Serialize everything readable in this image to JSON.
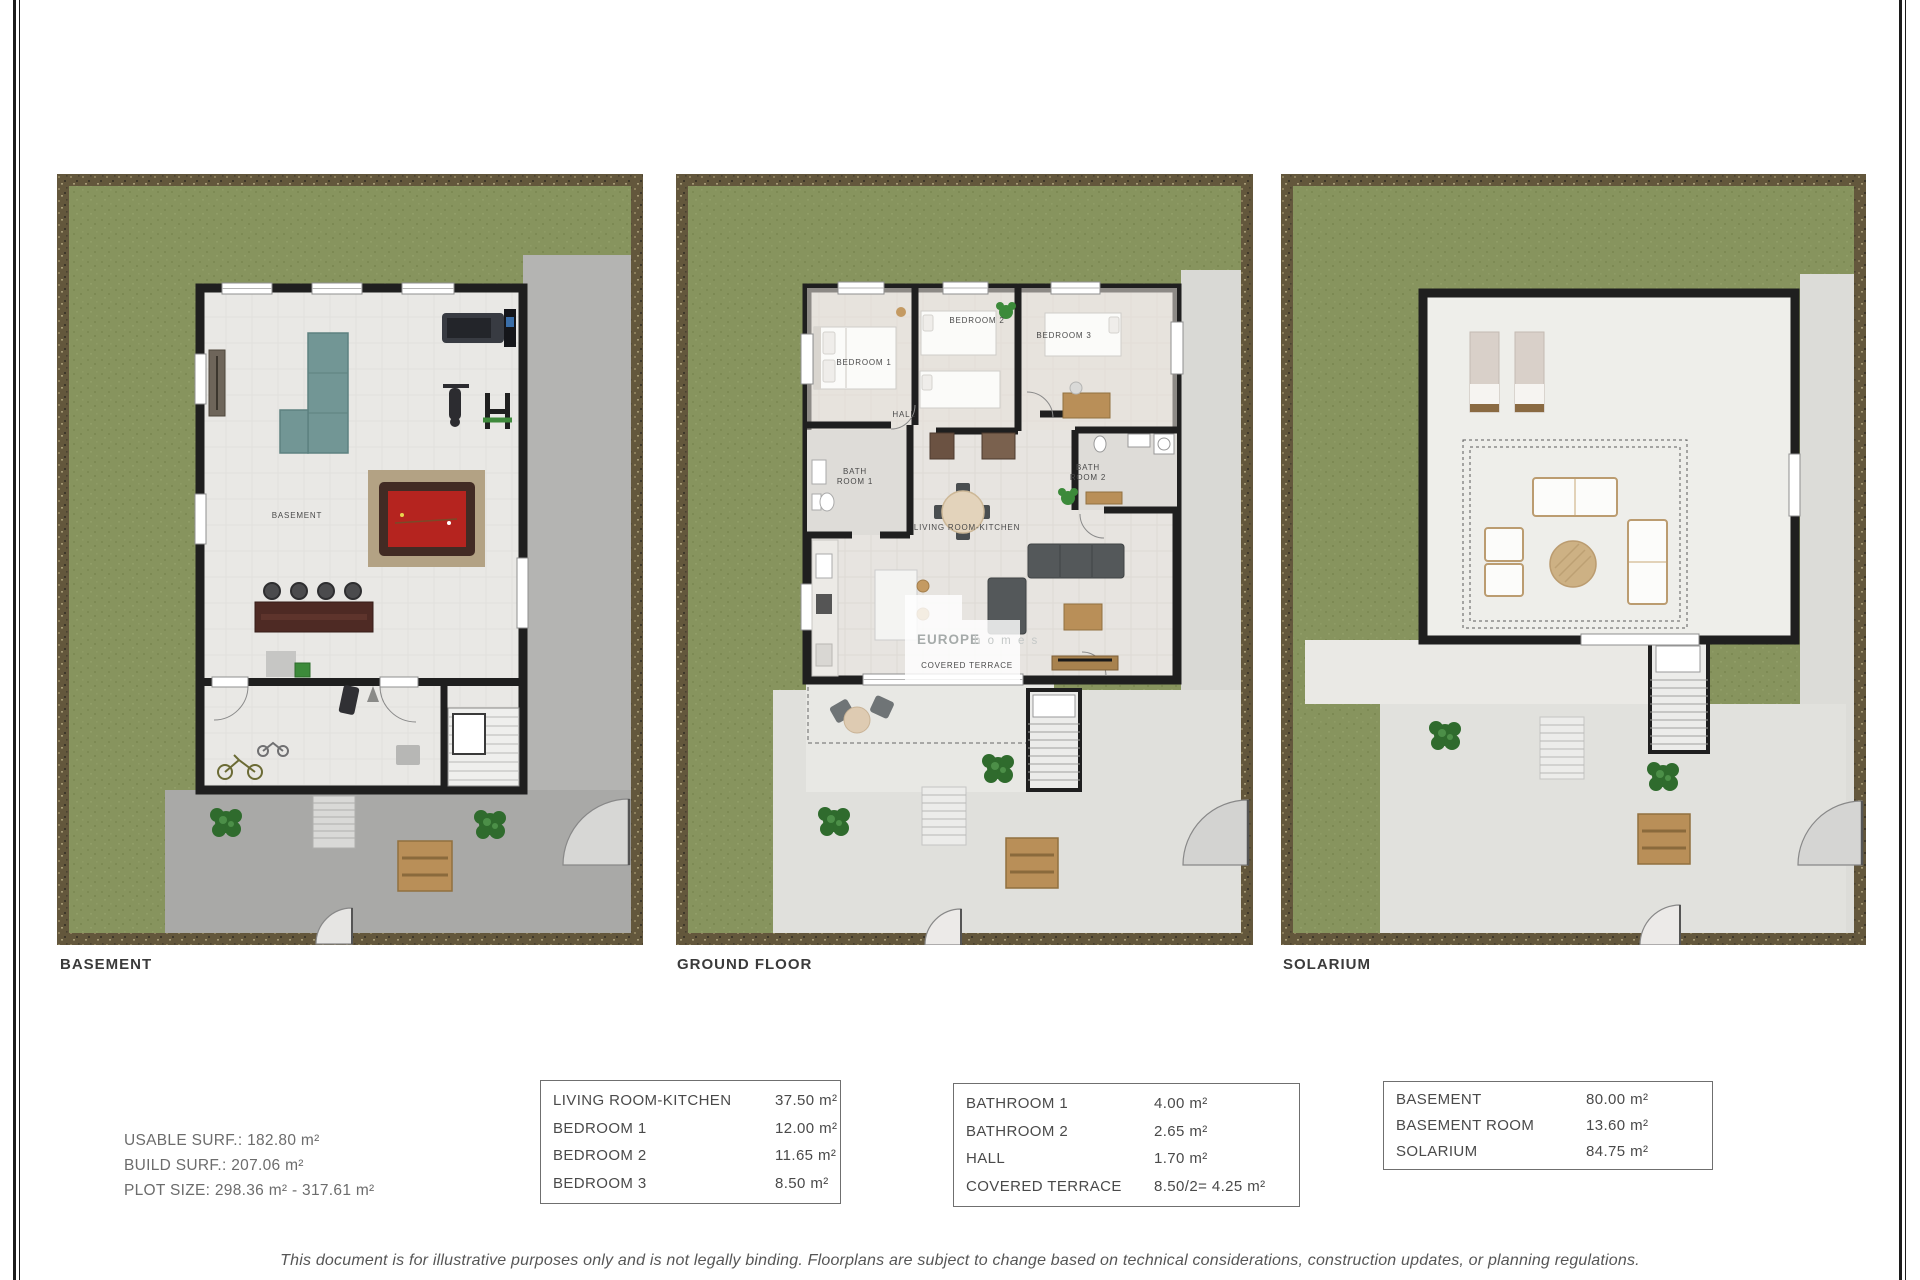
{
  "plans": [
    {
      "caption": "BASEMENT",
      "room_label": "BASEMENT"
    },
    {
      "caption": "GROUND FLOOR",
      "rooms": {
        "bedroom1": "BEDROOM 1",
        "bedroom2": "BEDROOM 2",
        "bedroom3": "BEDROOM 3",
        "hall": "HALL",
        "bath_line1": "BATH",
        "bath1_line2": "ROOM 1",
        "bath2_line2": "ROOM 2",
        "living_kitchen": "LIVING ROOM-KITCHEN",
        "covered_terrace": "COVERED TERRACE"
      }
    },
    {
      "caption": "SOLARIUM"
    }
  ],
  "watermark": {
    "primary": "EUROPE",
    "secondary": "h o m e s"
  },
  "summary": {
    "usable": "USABLE SURF.: 182.80 m²",
    "build": "BUILD SURF.: 207.06 m²",
    "plot": "PLOT SIZE: 298.36 m² - 317.61 m²"
  },
  "tables": [
    {
      "rows": [
        {
          "name": "LIVING ROOM-KITCHEN",
          "value": "37.50 m²"
        },
        {
          "name": "BEDROOM 1",
          "value": "12.00 m²"
        },
        {
          "name": "BEDROOM 2",
          "value": "11.65 m²"
        },
        {
          "name": "BEDROOM 3",
          "value": "8.50 m²"
        }
      ]
    },
    {
      "rows": [
        {
          "name": "BATHROOM 1",
          "value": "4.00 m²"
        },
        {
          "name": "BATHROOM 2",
          "value": "2.65 m²"
        },
        {
          "name": "HALL",
          "value": "1.70 m²"
        },
        {
          "name": "COVERED TERRACE",
          "value": "8.50/2= 4.25 m²"
        }
      ]
    },
    {
      "rows": [
        {
          "name": "BASEMENT",
          "value": "80.00 m²"
        },
        {
          "name": "BASEMENT ROOM",
          "value": "13.60 m²"
        },
        {
          "name": "SOLARIUM",
          "value": "84.75 m²"
        }
      ]
    }
  ],
  "disclaimer": "This document is for illustrative purposes only and is not legally binding. Floorplans are subject to change based on technical considerations, construction updates, or planning regulations.",
  "colors": {
    "grass": "#87945e",
    "soil": "#63573c",
    "wall": "#1f1f1f",
    "concrete_dark": "#a9a9a7",
    "concrete_light": "#dfdfdb",
    "pool_table_red": "#b5241f",
    "sofa_teal": "#729695",
    "wood": "#b98f58"
  }
}
